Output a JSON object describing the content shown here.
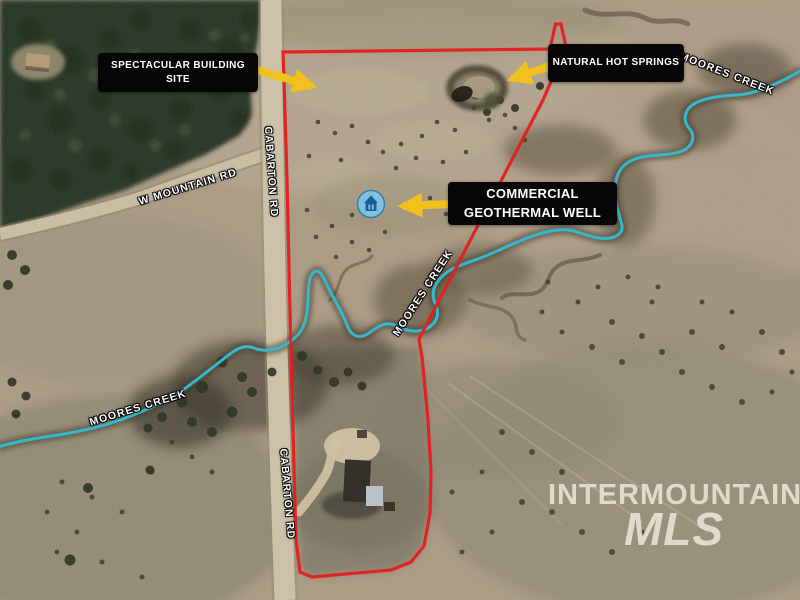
{
  "map": {
    "callouts": {
      "building_site": {
        "label": "SPECTACULAR BUILDING SITE"
      },
      "hot_springs": {
        "label": "NATURAL HOT SPRINGS"
      },
      "geothermal_well": {
        "label": "COMMERCIAL GEOTHERMAL WELL"
      }
    },
    "roads": {
      "w_mountain_rd": "W MOUNTAIN RD",
      "cabarton_rd_upper": "CABARTON RD",
      "cabarton_rd_lower": "CABARTON RD"
    },
    "creeks": {
      "moores_creek_left": "MOORES CREEK",
      "moores_creek_middle": "MOORES CREEK",
      "moores_creek_top_right": "MOORES CREEK"
    },
    "watermark": {
      "brand": "INTERMOUNTAIN",
      "brand_sub": "MLS"
    },
    "icons": {
      "well_marker": "geothermal-well-icon"
    },
    "colors": {
      "property_boundary": "#e51d1d",
      "creek_highlight": "#35b8cc",
      "annotation_arrow": "#f1c11d",
      "callout_background": "#070707",
      "callout_text": "#ffffff",
      "well_icon_blue": "#7fc3e3"
    }
  }
}
